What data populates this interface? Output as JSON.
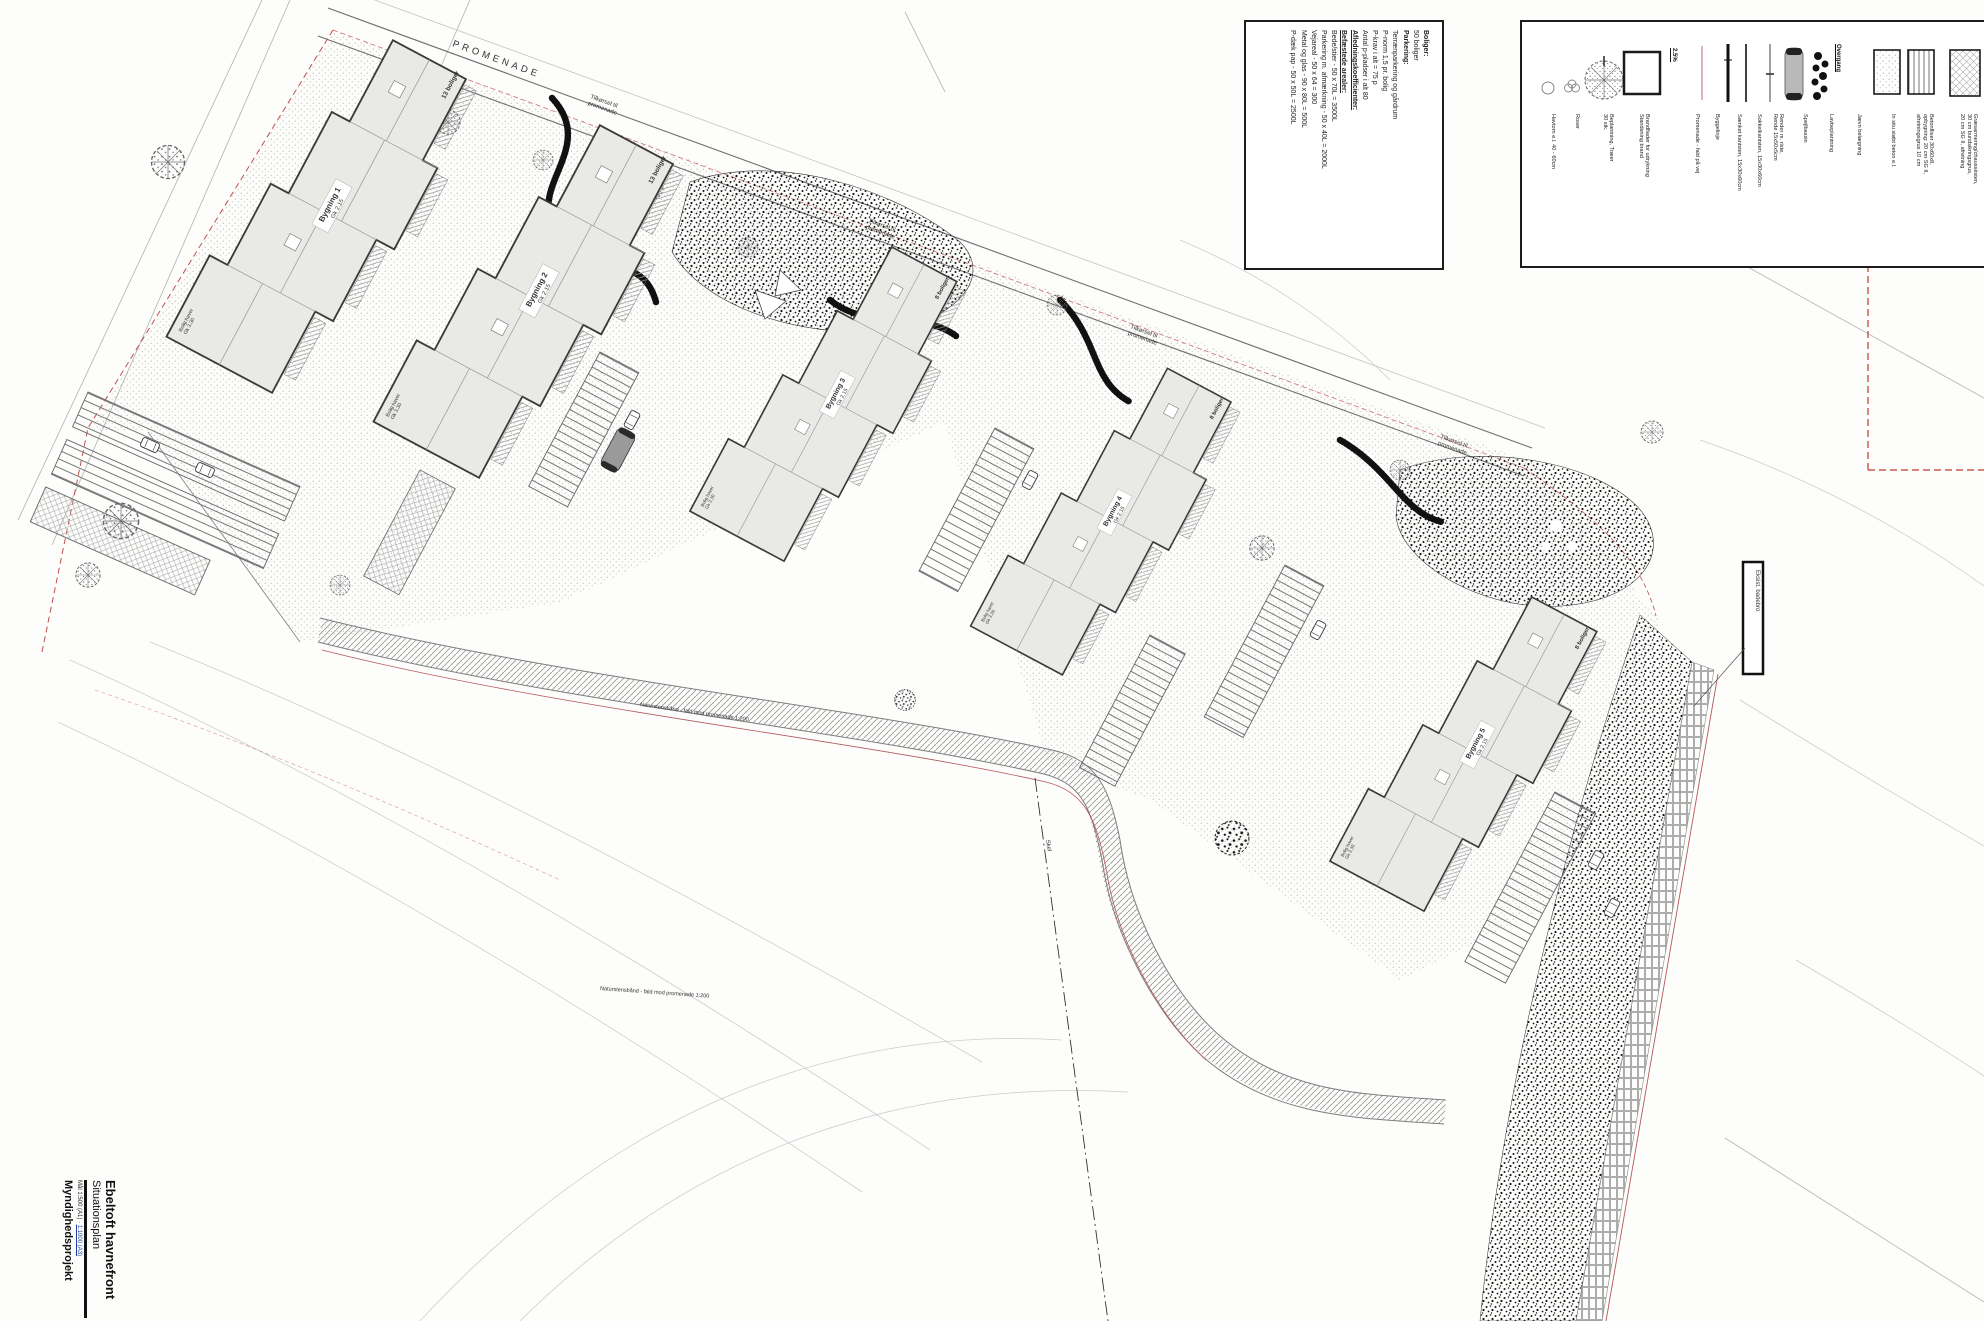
{
  "title_block": {
    "project": "Ebeltoft havnefront",
    "drawing": "Situationsplan",
    "meta_plain": "Mål 1:500 (A1) · ",
    "meta_link": "1:1000 (A3)",
    "phase": "Myndighedsprojekt"
  },
  "roads": {
    "promenade": "PROMENADE",
    "access_1": "Tilkørsel til",
    "access_2": "promenade"
  },
  "buildings": [
    {
      "name": "Bygning 1",
      "level": "Gk 2.15",
      "units": "13 boliger"
    },
    {
      "name": "Bygning 2",
      "level": "Gk 2.15",
      "units": "13 boliger"
    },
    {
      "name": "Bygning 3",
      "level": "Gk 2.15",
      "units": "8 boliger"
    },
    {
      "name": "Bygning 4",
      "level": "Gk 2.15",
      "units": "8 boliger"
    },
    {
      "name": "Bygning 5",
      "level": "Gk 2.15",
      "units": "8 boliger"
    }
  ],
  "site": {
    "garden_1": "Bolig haver",
    "garden_2": "Gk 3.30",
    "skel": "Skel",
    "path_note": "Naturstensbånd - fald mod promenade 1:200",
    "sign": "Eksist. badebro"
  },
  "info_box": {
    "lines": [
      "Boliger:",
      "50 boliger",
      "",
      "Parkering:",
      "Terrænparkering og gårdrum",
      "P-norm 1,5 pr. bolig",
      "P-krav i alt = 75 p",
      "",
      "Antal p-pladser i alt 80",
      "",
      "Afledningskoefficienter:",
      "Befæstede arealer:",
      "",
      "Bede/stier - 50 x 70L = 3500L",
      "Parkering m. afmærkning - 50 x 40L = 2000L",
      "Vejareal - 50 x 64 = 300",
      "Metal og glas - 90 x 80L = 500L",
      "P-dæk pap - 50 x 50L = 2500L"
    ]
  },
  "legend": {
    "slope_value": "2.5%",
    "overgang": "Overgang",
    "items": [
      {
        "icon": "havtorn-icon",
        "label": "Havtorn e.l. 40 - 60cm"
      },
      {
        "icon": "roser-icon",
        "label": "Roser"
      },
      {
        "icon": "tree-icon",
        "label": "Beplantning, Træer\n30 stk."
      },
      {
        "icon": "brandflade-icon",
        "label": "Brandflader for udrykning\nStandsning brand"
      },
      {
        "icon": "slope-icon",
        "label": "Promenade - fald på vej"
      },
      {
        "icon": "byggelinje-icon",
        "label": "Byggelinje"
      },
      {
        "icon": "kantsten-thick-icon",
        "label": "Sænket kantsten, 15x30x60cm"
      },
      {
        "icon": "kantsten-thin-icon",
        "label": "Sokkelkantsten, 15x30x60cm"
      },
      {
        "icon": "rende-icon",
        "label": "Render m. riste,\nRende 15x50x5cm"
      },
      {
        "icon": "spejlbassin-icon",
        "label": "Spejlbassin"
      },
      {
        "icon": "lavbeplantning-icon",
        "label": "Lavbeplantning"
      },
      {
        "icon": "overgang-icon",
        "label": "Jævn belægning"
      },
      {
        "icon": "beton-swatch",
        "label": "In situ støbt beton e.l."
      },
      {
        "icon": "fliser-swatch",
        "label": "Betonfliser 30x60x8,\nopbygning: 20 cm SG II,\nafretningsgrus 10 cm"
      },
      {
        "icon": "graesarmering-swatch",
        "label": "Græsarmering/chaussésten,\n30 cm bundsikringsgrus,\n20 cm SG II, afretning"
      }
    ]
  },
  "colors": {
    "line": "#3a3a3a",
    "building_fill": "#e9e9e6",
    "boundary_red": "#c0504d",
    "byggelinje_pink": "#d9a0a4",
    "contour": "#c9c9c9",
    "dark_planting": "#141414"
  }
}
